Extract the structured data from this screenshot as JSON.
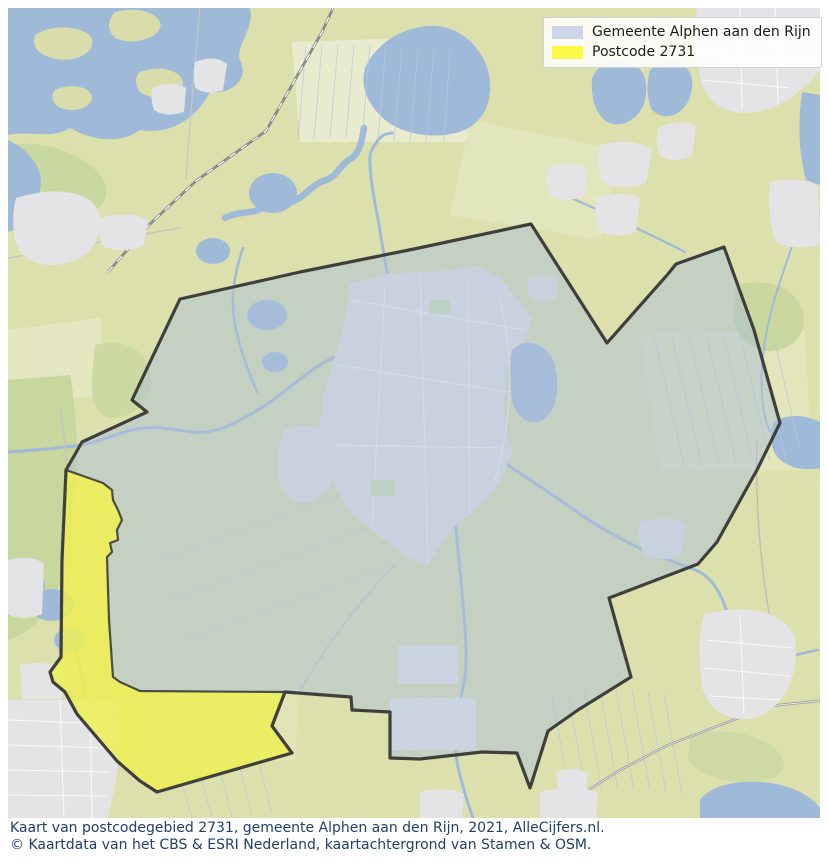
{
  "legend": {
    "items": [
      {
        "label": "Gemeente Alphen aan den Rijn",
        "swatch_color": "#ccd6e6"
      },
      {
        "label": "Postcode 2731",
        "swatch_color": "#fcf94b"
      }
    ]
  },
  "caption": {
    "line1": "Kaart van postcodegebied 2731, gemeente Alphen aan den Rijn, 2021, AlleCijfers.nl.",
    "line2": "© Kaartdata van het CBS & ESRI Nederland, kaartachtergrond van Stamen & OSM."
  },
  "map": {
    "year": "2021",
    "gemeente": {
      "name": "Gemeente Alphen aan den Rijn",
      "fill": "rgba(172,191,215,0.5)",
      "stroke": "#3f3f3c",
      "points": "180,299 300,272 414,249 531,224 607,343 668,274 676,264 724,247 754,330 780,423 757,470 753,477 717,542 698,564 609,598 631,677 578,710 548,731 530,788 517,753 482,752 420,759 390,758 390,712 352,710 351,697 285,692 272,726 292,753 157,792 140,781 117,761 77,714 65,692 53,682 50,672 61,657 62,560 66,470 82,442 147,412 132,400"
    },
    "postcode": {
      "name": "Postcode 2731",
      "fill": "rgba(250,246,60,0.72)",
      "stroke": "#4c4c42",
      "points": "66,470 103,483 112,490 113,500 118,510 122,520 117,530 118,540 110,543 112,552 107,557 109,620 113,677 120,682 140,691 285,692 272,726 292,753 157,792 140,781 117,761 77,714 65,692 53,682 50,672 61,657 62,560"
    }
  }
}
